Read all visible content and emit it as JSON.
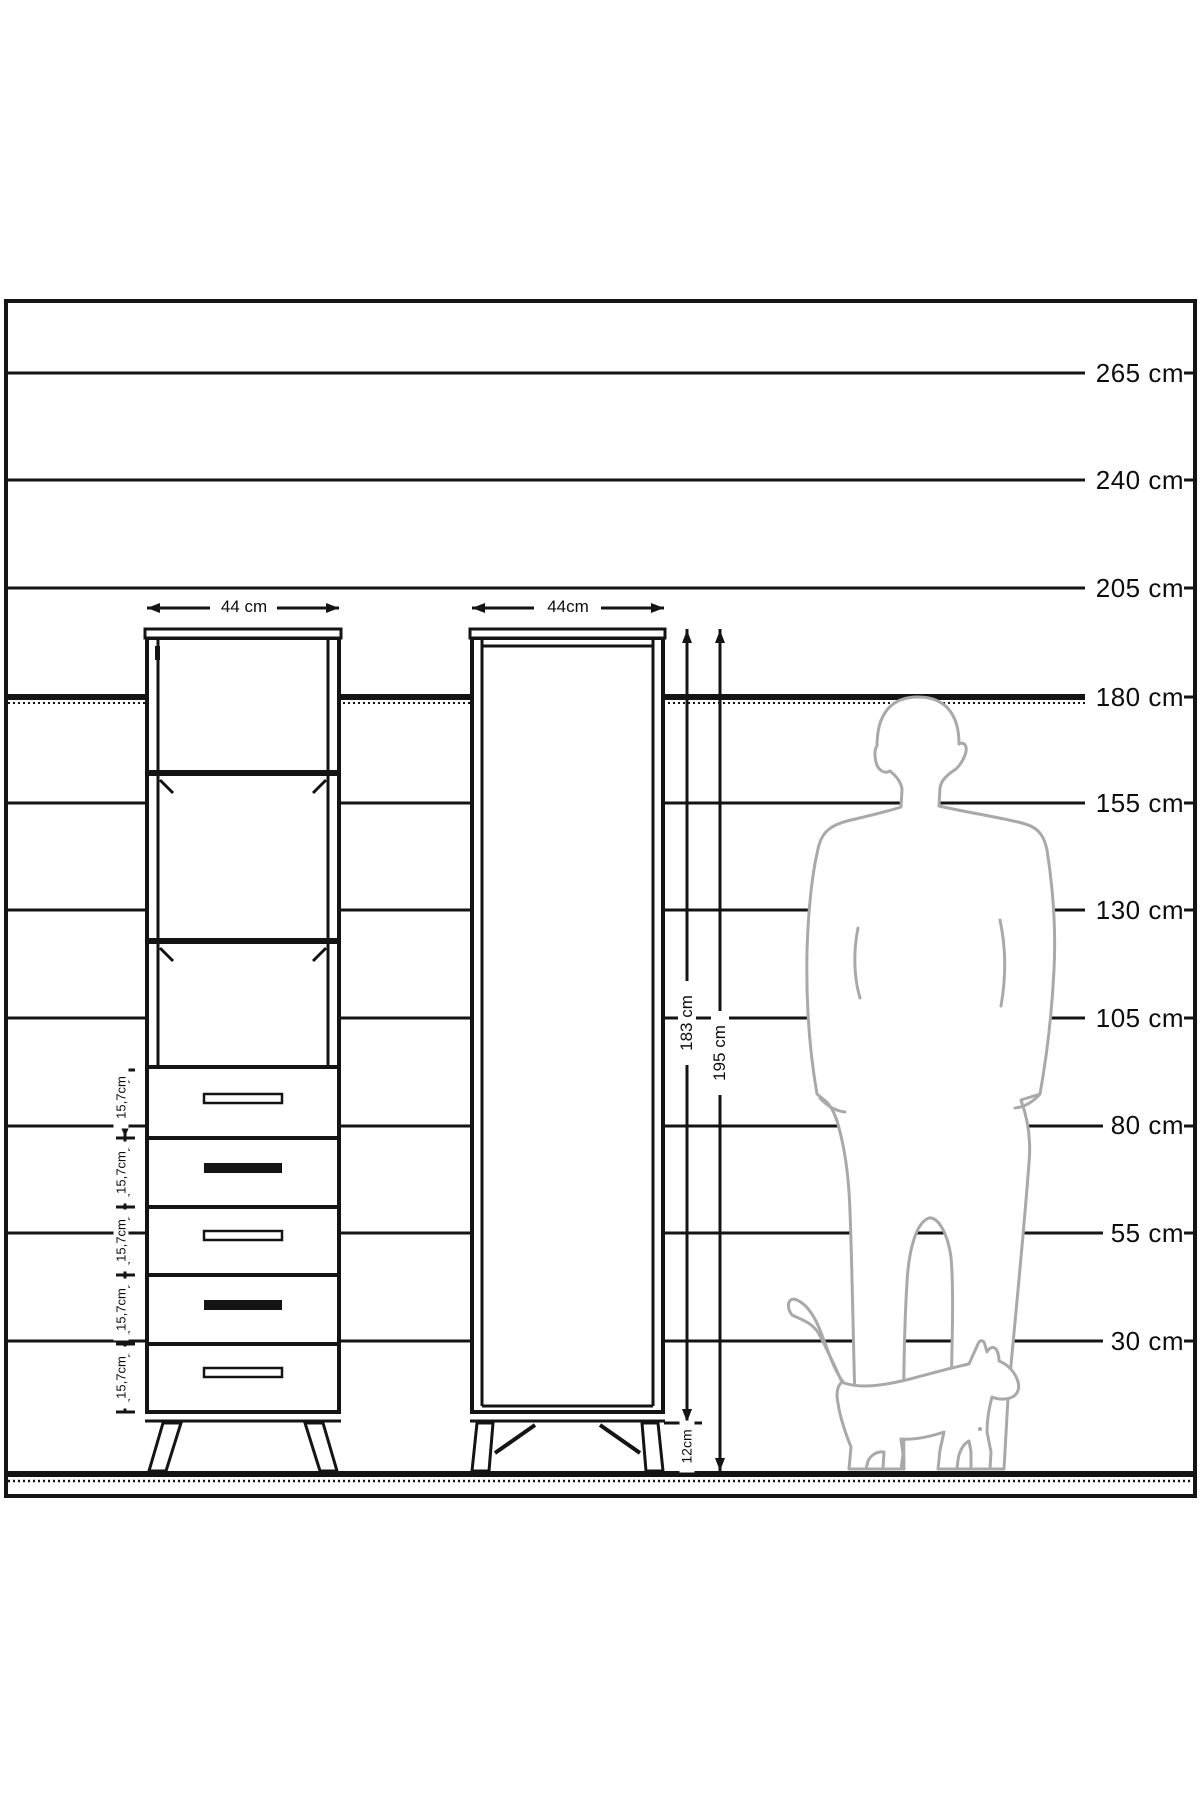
{
  "page": {
    "type": "furniture height dimension diagram",
    "unit": "cm",
    "background": "#ffffff"
  },
  "scale": {
    "labels": [
      {
        "text": "265 cm"
      },
      {
        "text": "240 cm"
      },
      {
        "text": "205 cm"
      },
      {
        "text": "180 cm"
      },
      {
        "text": "155 cm"
      },
      {
        "text": "130 cm"
      },
      {
        "text": "105 cm"
      },
      {
        "text": "80 cm"
      },
      {
        "text": "55 cm"
      },
      {
        "text": "30 cm"
      }
    ]
  },
  "dimensions": {
    "cabinet_open_width": "44 cm",
    "cabinet_closed_width": "44cm",
    "carcass_height": "183 cm",
    "total_height": "195 cm",
    "leg_height": "12cm",
    "drawer_heights": [
      "15,7cm",
      "15,7cm",
      "15,7cm",
      "15,7cm",
      "15,7cm"
    ]
  },
  "colors": {
    "line": "#141414",
    "silhouette": "#a9a9a9"
  }
}
